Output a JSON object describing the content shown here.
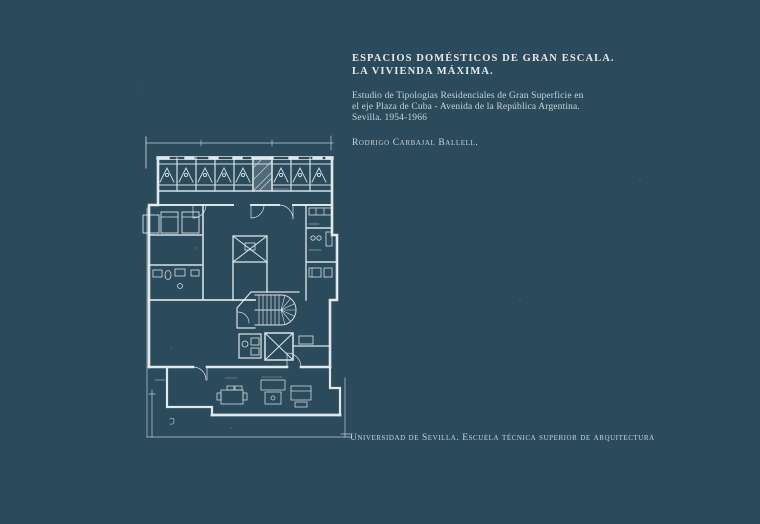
{
  "colors": {
    "background": "#2b4a5b",
    "title_text": "#e4eaeb",
    "body_text": "#c9d4d8",
    "plan_lines": "#e9f1f3"
  },
  "header": {
    "title_line1": "ESPACIOS DOMÉSTICOS DE GRAN ESCALA.",
    "title_line2": "LA VIVIENDA MÁXIMA.",
    "subtitle_line1": "Estudio de Tipologías Residenciales de Gran Superficie en",
    "subtitle_line2": "el eje Plaza de Cuba - Avenida de la República Argentina.",
    "subtitle_line3": "Sevilla. 1954-1966",
    "author": "Rodrigo Carbajal Ballell."
  },
  "footer": {
    "institution": "Universidad de Sevilla. Escuela técnica superior de arquitectura"
  }
}
